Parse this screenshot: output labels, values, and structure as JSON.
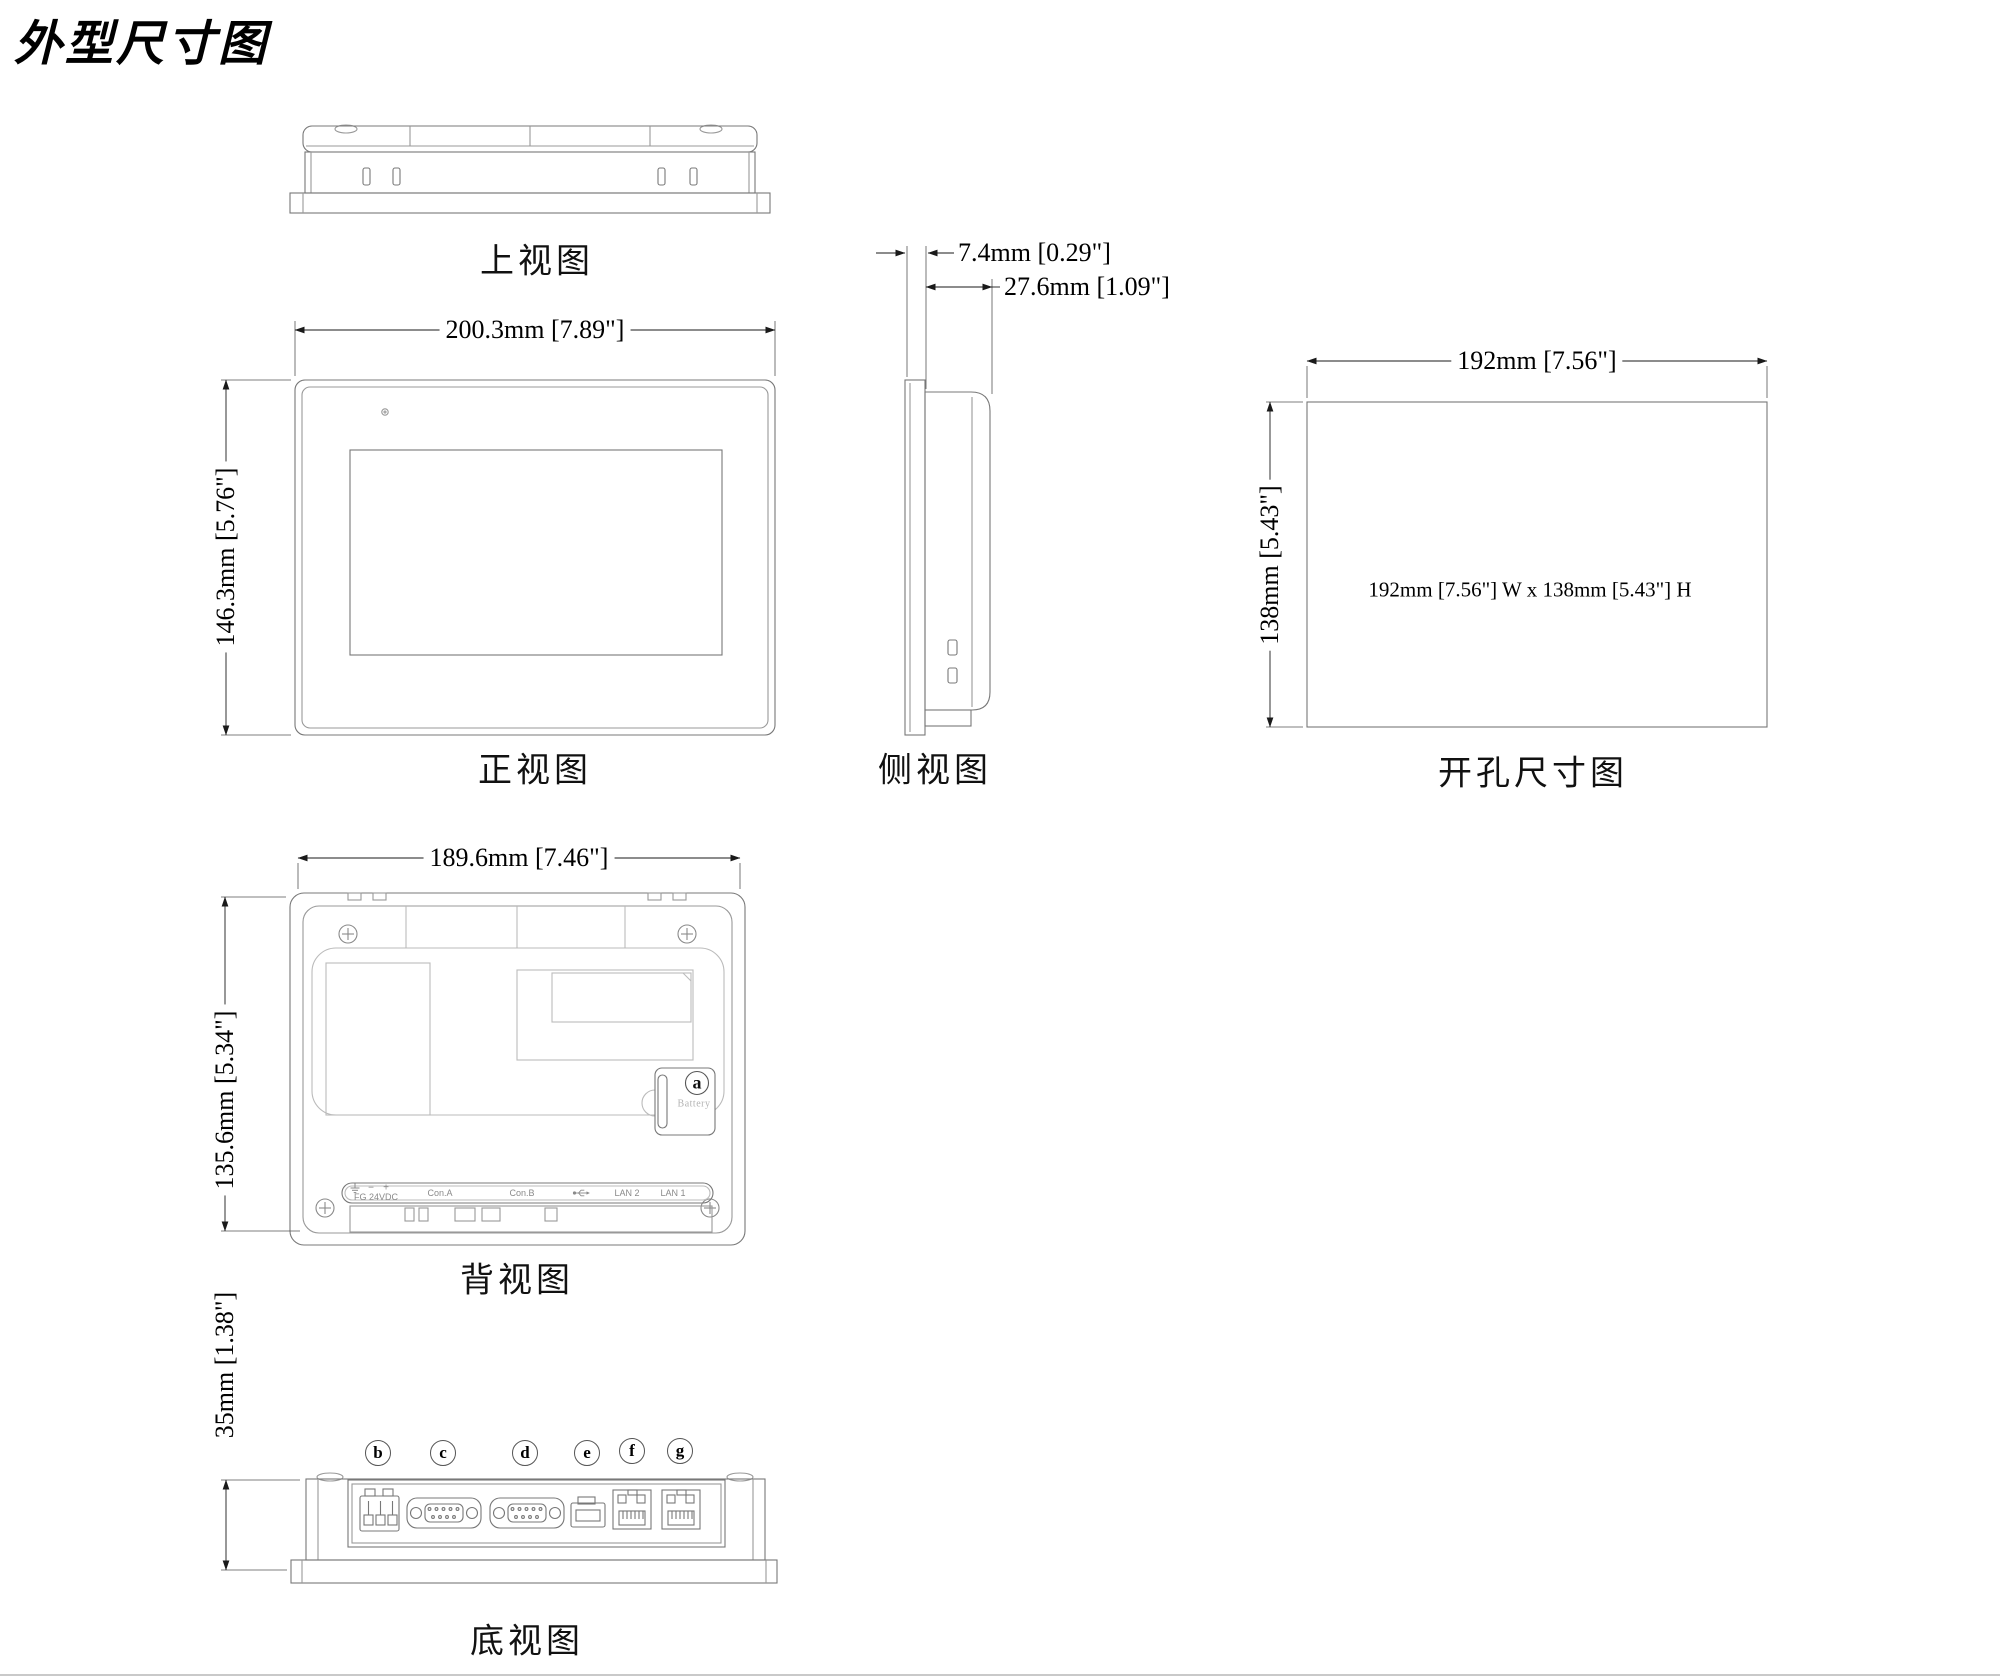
{
  "page": {
    "title": "外型尺寸图"
  },
  "top_view": {
    "label": "上视图"
  },
  "front_view": {
    "label": "正视图",
    "width_dim": "200.3mm [7.89\"]",
    "height_dim": "146.3mm [5.76\"]"
  },
  "side_view": {
    "label": "侧视图",
    "bezel_dim": "7.4mm [0.29\"]",
    "depth_dim": "27.6mm [1.09\"]"
  },
  "cutout_view": {
    "label": "开孔尺寸图",
    "width_dim": "192mm [7.56\"]",
    "height_dim": "138mm [5.43\"]",
    "cutout_note": "192mm [7.56\"] W x 138mm [5.43\"] H"
  },
  "back_view": {
    "label": "背视图",
    "width_dim": "189.6mm [7.46\"]",
    "height_dim": "135.6mm [5.34\"]",
    "battery_callout": "a",
    "battery_label": "Battery",
    "minus": "−",
    "plus": "+",
    "ports": [
      "FG 24VDC",
      "Con.A",
      "Con.B",
      "LAN 2",
      "LAN 1"
    ]
  },
  "bottom_view": {
    "label": "底视图",
    "height_dim": "35mm [1.38\"]",
    "callouts": [
      "b",
      "c",
      "d",
      "e",
      "f",
      "g"
    ]
  }
}
